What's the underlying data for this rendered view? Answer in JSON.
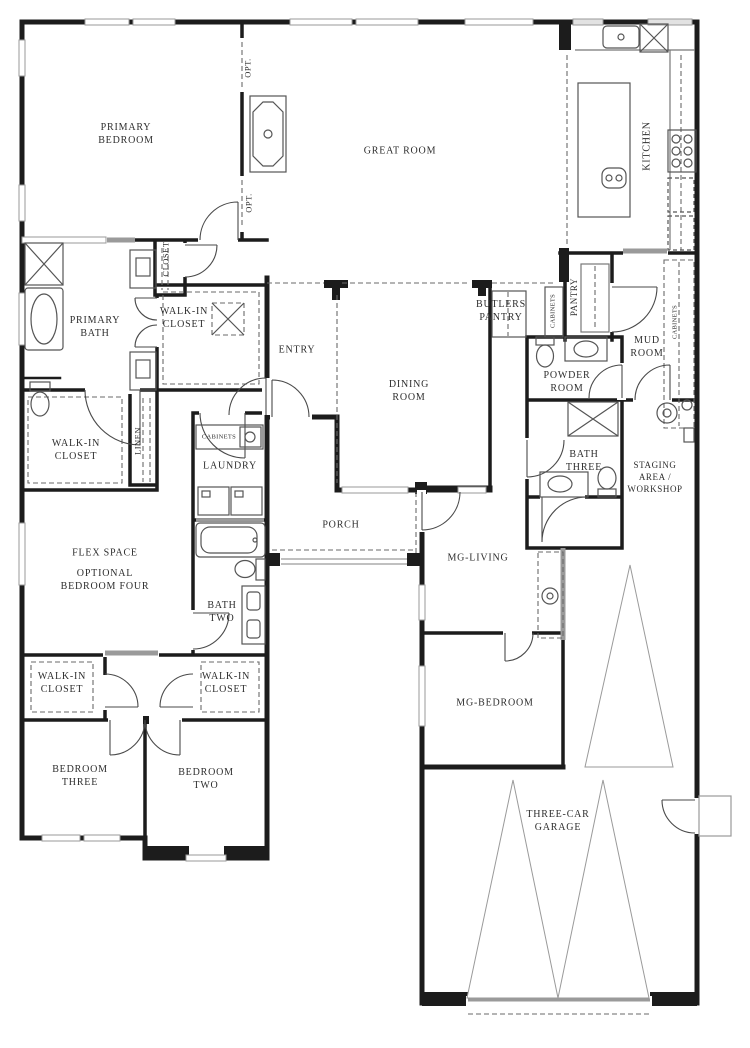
{
  "plan": {
    "type": "single-story-residential-floor-plan",
    "colors": {
      "wall": "#1c1c1c",
      "thin_line": "#555555",
      "window": "#9a9a9a",
      "dashed": "#6a6a6a",
      "background": "#ffffff"
    },
    "labels": {
      "primary_bedroom": "PRIMARY\nBEDROOM",
      "great_room": "GREAT ROOM",
      "kitchen": "KITCHEN",
      "opt_1": "OPT.",
      "opt_2": "OPT.",
      "closet": "CLOSET",
      "primary_bath": "PRIMARY\nBATH",
      "walk_in_closet_primary": "WALK-IN\nCLOSET",
      "entry": "ENTRY",
      "butlers_pantry": "BUTLERS\nPANTRY",
      "cabinets_butlers": "CABINETS",
      "pantry": "PANTRY",
      "mud_room": "MUD\nROOM",
      "cabinets_mud": "CABINETS",
      "dining_room": "DINING\nROOM",
      "powder_room": "POWDER\nROOM",
      "walk_in_closet_hall": "WALK-IN\nCLOSET",
      "linen": "LINEN",
      "cabinets_laundry": "CABINETS",
      "laundry": "LAUNDRY",
      "bath_three": "BATH\nTHREE",
      "staging_area": "STAGING\nAREA /\nWORKSHOP",
      "flex_space": "FLEX SPACE",
      "optional_bedroom_four": "OPTIONAL\nBEDROOM FOUR",
      "porch": "PORCH",
      "mg_living": "MG-LIVING",
      "bath_two": "BATH\nTWO",
      "walk_in_closet_left": "WALK-IN\nCLOSET",
      "walk_in_closet_right": "WALK-IN\nCLOSET",
      "mg_bedroom": "MG-BEDROOM",
      "bedroom_three": "BEDROOM\nTHREE",
      "bedroom_two": "BEDROOM\nTWO",
      "three_car_garage": "THREE-CAR\nGARAGE"
    }
  }
}
